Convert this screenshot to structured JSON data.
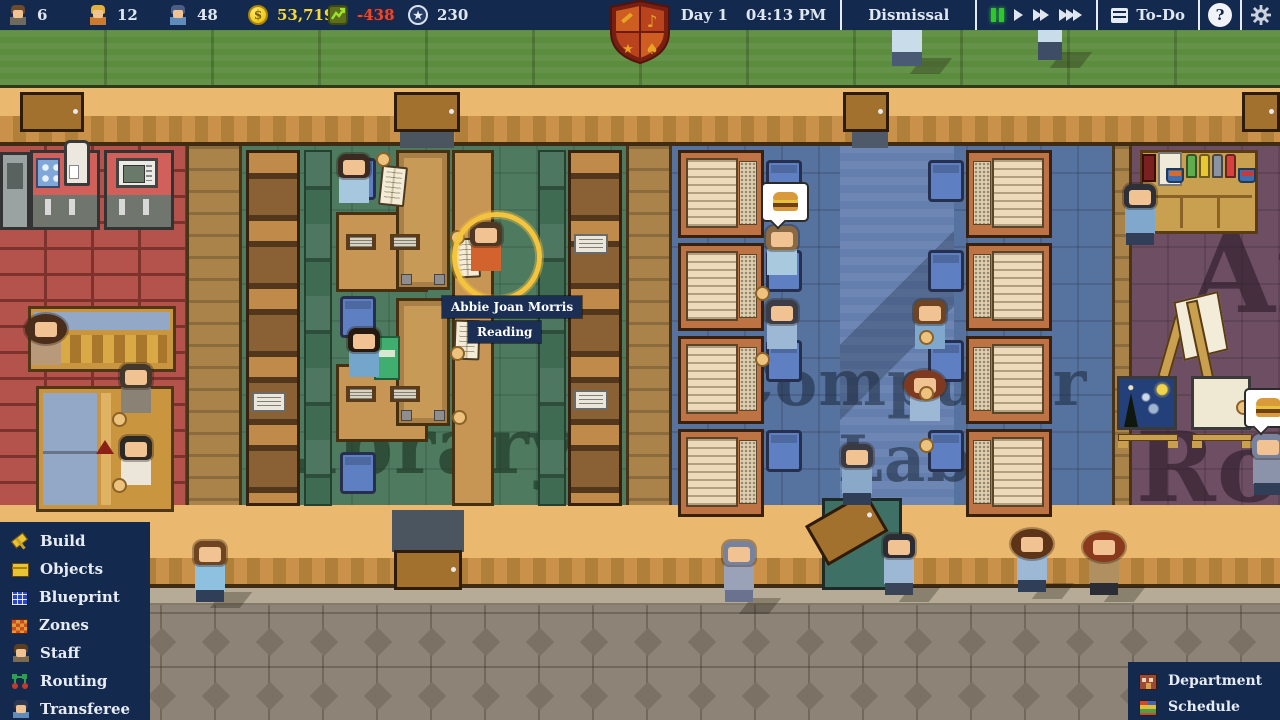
{
  "topbar": {
    "stats": [
      {
        "label": "6",
        "icon": "teacher-icon"
      },
      {
        "label": "12",
        "icon": "student-icon"
      },
      {
        "label": "48",
        "icon": "worker-icon"
      },
      {
        "label": "53,719",
        "icon": "money-icon"
      },
      {
        "label": "-438",
        "icon": "cashflow-icon"
      },
      {
        "label": "230",
        "icon": "points-icon"
      }
    ],
    "year": "Y1",
    "day": "Day 1",
    "time": "04:13 PM",
    "period": "Dismissal",
    "todo": "To-Do",
    "help": "?"
  },
  "crest": {
    "music": "♪",
    "star": "★",
    "leaf": "♠"
  },
  "scene": {
    "selected": {
      "name": "Abbie Joan Morris",
      "activity": "Reading"
    },
    "rooms": {
      "library": "Library",
      "computer_lab": [
        "Computer",
        "Lab"
      ],
      "art_room": [
        "Art",
        "Room"
      ]
    }
  },
  "build_menu": {
    "items": [
      {
        "label": "Build",
        "icon": "build-icon"
      },
      {
        "label": "Objects",
        "icon": "objects-icon"
      },
      {
        "label": "Blueprint",
        "icon": "blueprint-icon"
      },
      {
        "label": "Zones",
        "icon": "zones-icon"
      },
      {
        "label": "Staff",
        "icon": "staff-icon"
      },
      {
        "label": "Routing",
        "icon": "routing-icon"
      },
      {
        "label": "Transferee",
        "icon": "transferee-icon"
      }
    ]
  },
  "manage_menu": {
    "items": [
      {
        "label": "Department",
        "icon": "department-icon"
      },
      {
        "label": "Schedule",
        "icon": "schedule-icon"
      }
    ]
  },
  "colors": {
    "topbar": "#14294e",
    "money": "#f7d931",
    "negative": "#e34a2e",
    "grass": "#5c8c3e",
    "library_floor": "#4e7a60",
    "lab_floor": "#56729e",
    "art_floor": "#6d4e63",
    "staff_floor": "#b4524c",
    "accent_green": "#2ec72e",
    "selection_ring": "#f4c43e"
  }
}
